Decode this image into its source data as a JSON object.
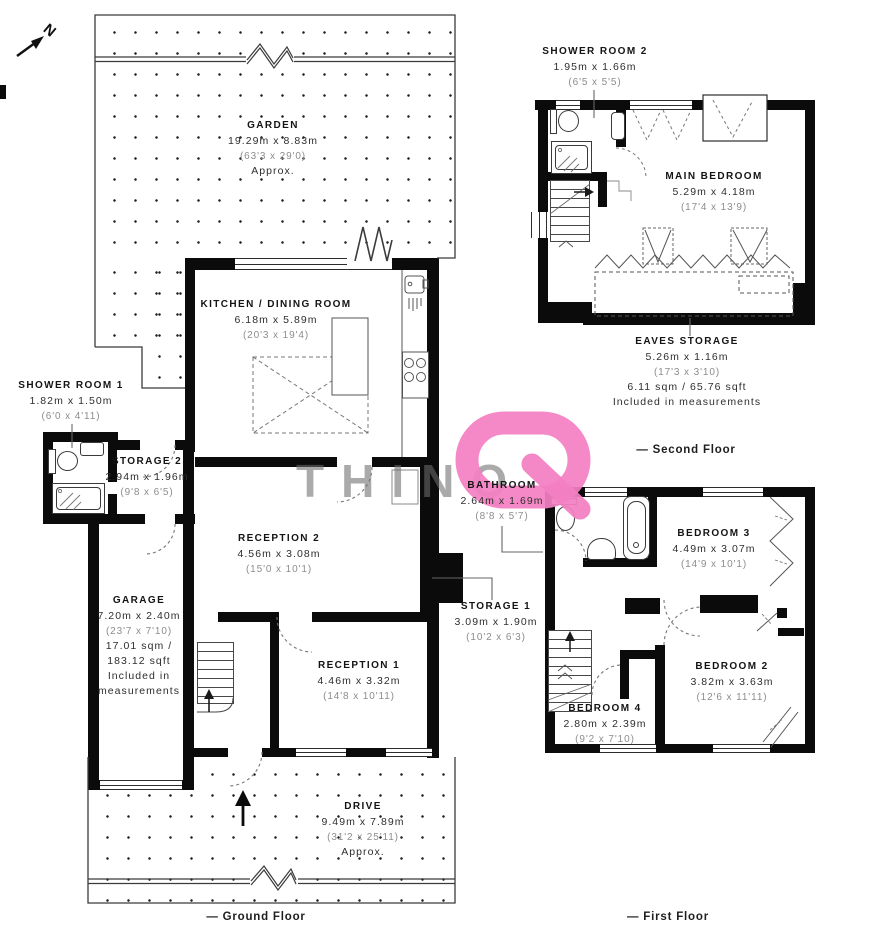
{
  "compass": {
    "label": "N"
  },
  "watermark": {
    "text": "THINQ",
    "accent_color": "#f480c3"
  },
  "floors": {
    "ground": {
      "caption": "— Ground Floor",
      "rooms": {
        "garden": {
          "name": "GARDEN",
          "metric": "19.29m x 8.83m",
          "imperial": "(63'3 x 29'0)",
          "note": "Approx."
        },
        "kitchen_dining": {
          "name": "KITCHEN / DINING ROOM",
          "metric": "6.18m x 5.89m",
          "imperial": "(20'3 x 19'4)"
        },
        "shower_room_1": {
          "name": "SHOWER ROOM 1",
          "metric": "1.82m x 1.50m",
          "imperial": "(6'0 x 4'11)"
        },
        "storage_2": {
          "name": "STORAGE 2",
          "metric": "2.94m x 1.96m",
          "imperial": "(9'8 x 6'5)"
        },
        "garage": {
          "name": "GARAGE",
          "metric": "7.20m x 2.40m",
          "imperial": "(23'7 x 7'10)",
          "area_line1": "17.01 sqm /",
          "area_line2": "183.12 sqft",
          "note_line1": "Included in",
          "note_line2": "measurements"
        },
        "reception_2": {
          "name": "RECEPTION 2",
          "metric": "4.56m x 3.08m",
          "imperial": "(15'0 x 10'1)"
        },
        "reception_1": {
          "name": "RECEPTION 1",
          "metric": "4.46m x 3.32m",
          "imperial": "(14'8 x 10'11)"
        },
        "storage_1": {
          "name": "STORAGE 1",
          "metric": "3.09m x 1.90m",
          "imperial": "(10'2 x 6'3)"
        },
        "drive": {
          "name": "DRIVE",
          "metric": "9.49m x 7.89m",
          "imperial": "(31'2 x 25'11)",
          "note": "Approx."
        }
      }
    },
    "first": {
      "caption": "— First Floor",
      "rooms": {
        "bathroom": {
          "name": "BATHROOM",
          "metric": "2.64m x 1.69m",
          "imperial": "(8'8 x 5'7)"
        },
        "bedroom_3": {
          "name": "BEDROOM 3",
          "metric": "4.49m x 3.07m",
          "imperial": "(14'9 x 10'1)"
        },
        "bedroom_2": {
          "name": "BEDROOM 2",
          "metric": "3.82m x 3.63m",
          "imperial": "(12'6 x 11'11)"
        },
        "bedroom_4": {
          "name": "BEDROOM 4",
          "metric": "2.80m x 2.39m",
          "imperial": "(9'2 x 7'10)"
        }
      }
    },
    "second": {
      "caption": "— Second Floor",
      "rooms": {
        "shower_room_2": {
          "name": "SHOWER ROOM 2",
          "metric": "1.95m x 1.66m",
          "imperial": "(6'5 x 5'5)"
        },
        "main_bedroom": {
          "name": "MAIN BEDROOM",
          "metric": "5.29m x 4.18m",
          "imperial": "(17'4 x 13'9)"
        },
        "eaves_storage": {
          "name": "EAVES STORAGE",
          "metric": "5.26m x 1.16m",
          "imperial": "(17'3 x 3'10)",
          "area_line": "6.11 sqm / 65.76 sqft",
          "note_line": "Included in measurements"
        }
      }
    }
  }
}
